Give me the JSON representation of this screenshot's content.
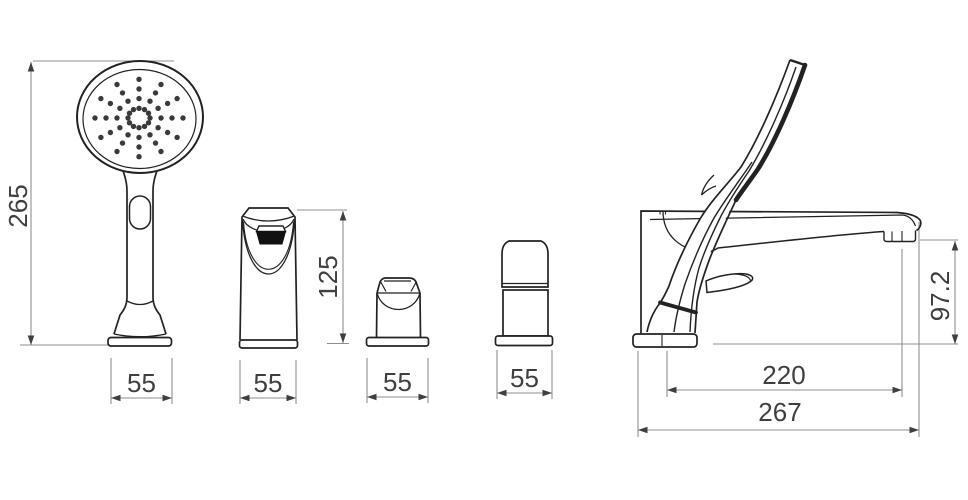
{
  "drawing": {
    "type": "technical-dimension-drawing",
    "subject": "bath-shower-mixer-faucet-set",
    "background": "#ffffff",
    "colors": {
      "object_line": "#222222",
      "dimension_line": "#8f8f8f",
      "label_text": "#3f3f3f"
    },
    "views": {
      "hand_shower": {
        "name": "hand-shower-front-view",
        "height": "265",
        "width": "55"
      },
      "mixer_column": {
        "name": "mixer-column-front-view",
        "height": "125",
        "width": "55"
      },
      "diverter_knob": {
        "name": "diverter-knob-front-view",
        "width": "55"
      },
      "valve_handle": {
        "name": "valve-handle-front-view",
        "width": "55"
      },
      "side_profile": {
        "name": "side-profile-view",
        "spout_height": "97.2",
        "spout_reach": "220",
        "overall_depth": "267"
      }
    }
  }
}
